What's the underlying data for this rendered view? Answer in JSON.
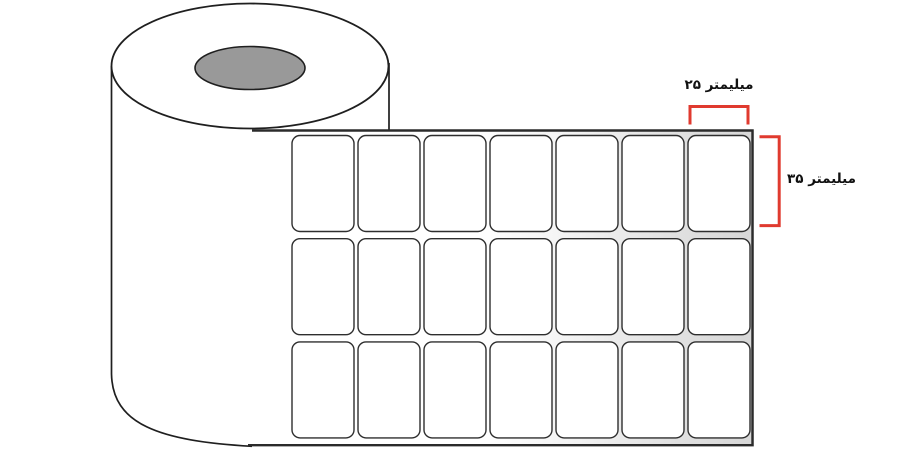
{
  "diagram": {
    "type": "label-roll-dimension-diagram",
    "annotations": {
      "label_width_text": "۲۵ میلیمتر",
      "label_height_text": "۳۵ میلیمتر"
    },
    "label_grid": {
      "rows": 3,
      "columns": 7
    },
    "colors": {
      "bracket_red": "#e03a2f",
      "core_gray": "#999999",
      "outline_dark": "#1f1f1f",
      "sheet_border": "#2b2b2b",
      "backing_gray": "#d7d7d7",
      "label_fill": "#ffffff"
    }
  }
}
